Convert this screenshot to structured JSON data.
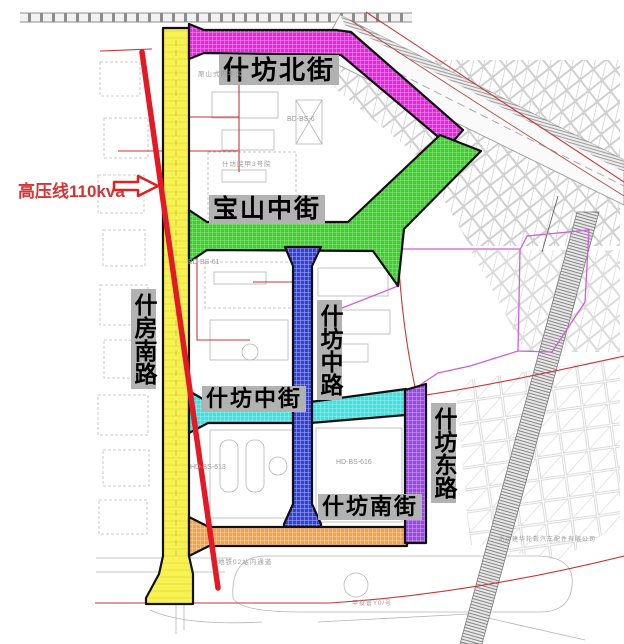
{
  "annotation": {
    "text": "高压线110kva",
    "color": "#d63333",
    "arrow": "right-block-arrow"
  },
  "streets": {
    "north_street": {
      "name": "什坊北街",
      "color": "#e724e0",
      "orientation": "horizontal"
    },
    "baoshan_street": {
      "name": "宝山中街",
      "color": "#3ecf2c",
      "orientation": "horizontal"
    },
    "middle_road": {
      "name": "什坊中路",
      "color": "#3040dd",
      "orientation": "vertical"
    },
    "middle_street": {
      "name": "什坊中街",
      "color": "#3fe0e0",
      "orientation": "horizontal"
    },
    "south_road": {
      "name": "什房南路",
      "color": "#f7f252",
      "orientation": "vertical"
    },
    "east_road": {
      "name": "什坊东路",
      "color": "#9b45ea",
      "orientation": "vertical"
    },
    "south_street": {
      "name": "什坊南街",
      "color": "#f2a34a",
      "orientation": "horizontal"
    }
  },
  "plots": {
    "p616": "HD-BS-616",
    "p613": "HD-BS-613",
    "p61": "BD-BS-61",
    "p6": "BD-BS-6",
    "compound": "什坊院甲3号院",
    "metro": "地铁02站内通道",
    "pingfang": "原山式内平房",
    "factory": "北京建华轮毂汽车配件有限公司",
    "pipe": "甲投管Y0/号"
  },
  "colors": {
    "high_voltage_line": "#e51825",
    "cadastral_red": "#c93636",
    "boundary_pink": "#cf5fd8",
    "label_bg": "#b2b2b2",
    "map_gray": "#b5b5b5"
  }
}
